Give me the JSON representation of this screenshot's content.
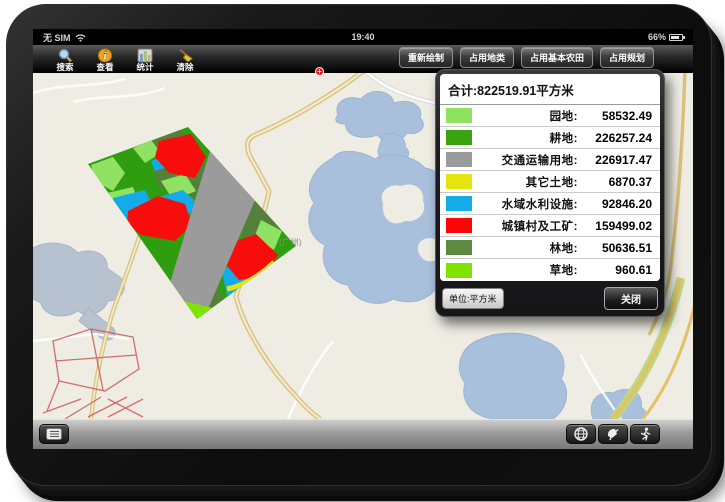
{
  "status_bar": {
    "carrier": "无 SIM",
    "time": "19:40",
    "battery_percent": "66%"
  },
  "toolbar": {
    "left_buttons": [
      {
        "label": "搜索",
        "icon": "search-icon"
      },
      {
        "label": "查看",
        "icon": "info-icon"
      },
      {
        "label": "统计",
        "icon": "bar-chart-icon"
      },
      {
        "label": "清除",
        "icon": "broom-icon"
      }
    ],
    "right_buttons": [
      {
        "label": "重新绘制"
      },
      {
        "label": "占用地类"
      },
      {
        "label": "占用基本农田"
      },
      {
        "label": "占用规划"
      }
    ]
  },
  "map": {
    "labels": [
      {
        "text": "(广州)"
      }
    ],
    "marker": "+"
  },
  "stats_panel": {
    "title": "合计:822519.91平方米",
    "rows": [
      {
        "label": "园地:",
        "value": "58532.49",
        "color": "#8ee35f"
      },
      {
        "label": "耕地:",
        "value": "226257.24",
        "color": "#3aa40e"
      },
      {
        "label": "交通运输用地:",
        "value": "226917.47",
        "color": "#9b9b9b"
      },
      {
        "label": "其它土地:",
        "value": "6870.37",
        "color": "#e6e40f"
      },
      {
        "label": "水域水利设施:",
        "value": "92846.20",
        "color": "#14ace8"
      },
      {
        "label": "城镇村及工矿:",
        "value": "159499.02",
        "color": "#fb0606"
      },
      {
        "label": "林地:",
        "value": "50636.51",
        "color": "#5c8a40"
      },
      {
        "label": "草地:",
        "value": "960.61",
        "color": "#7fe300"
      }
    ],
    "unit_button": "单位:平方米",
    "close_button": "关闭"
  },
  "colors": {
    "map_bg": "#efede3",
    "water": "#a9c0dc",
    "road_yellow": "#d9c279",
    "parcel_base": "#2e9e10"
  }
}
